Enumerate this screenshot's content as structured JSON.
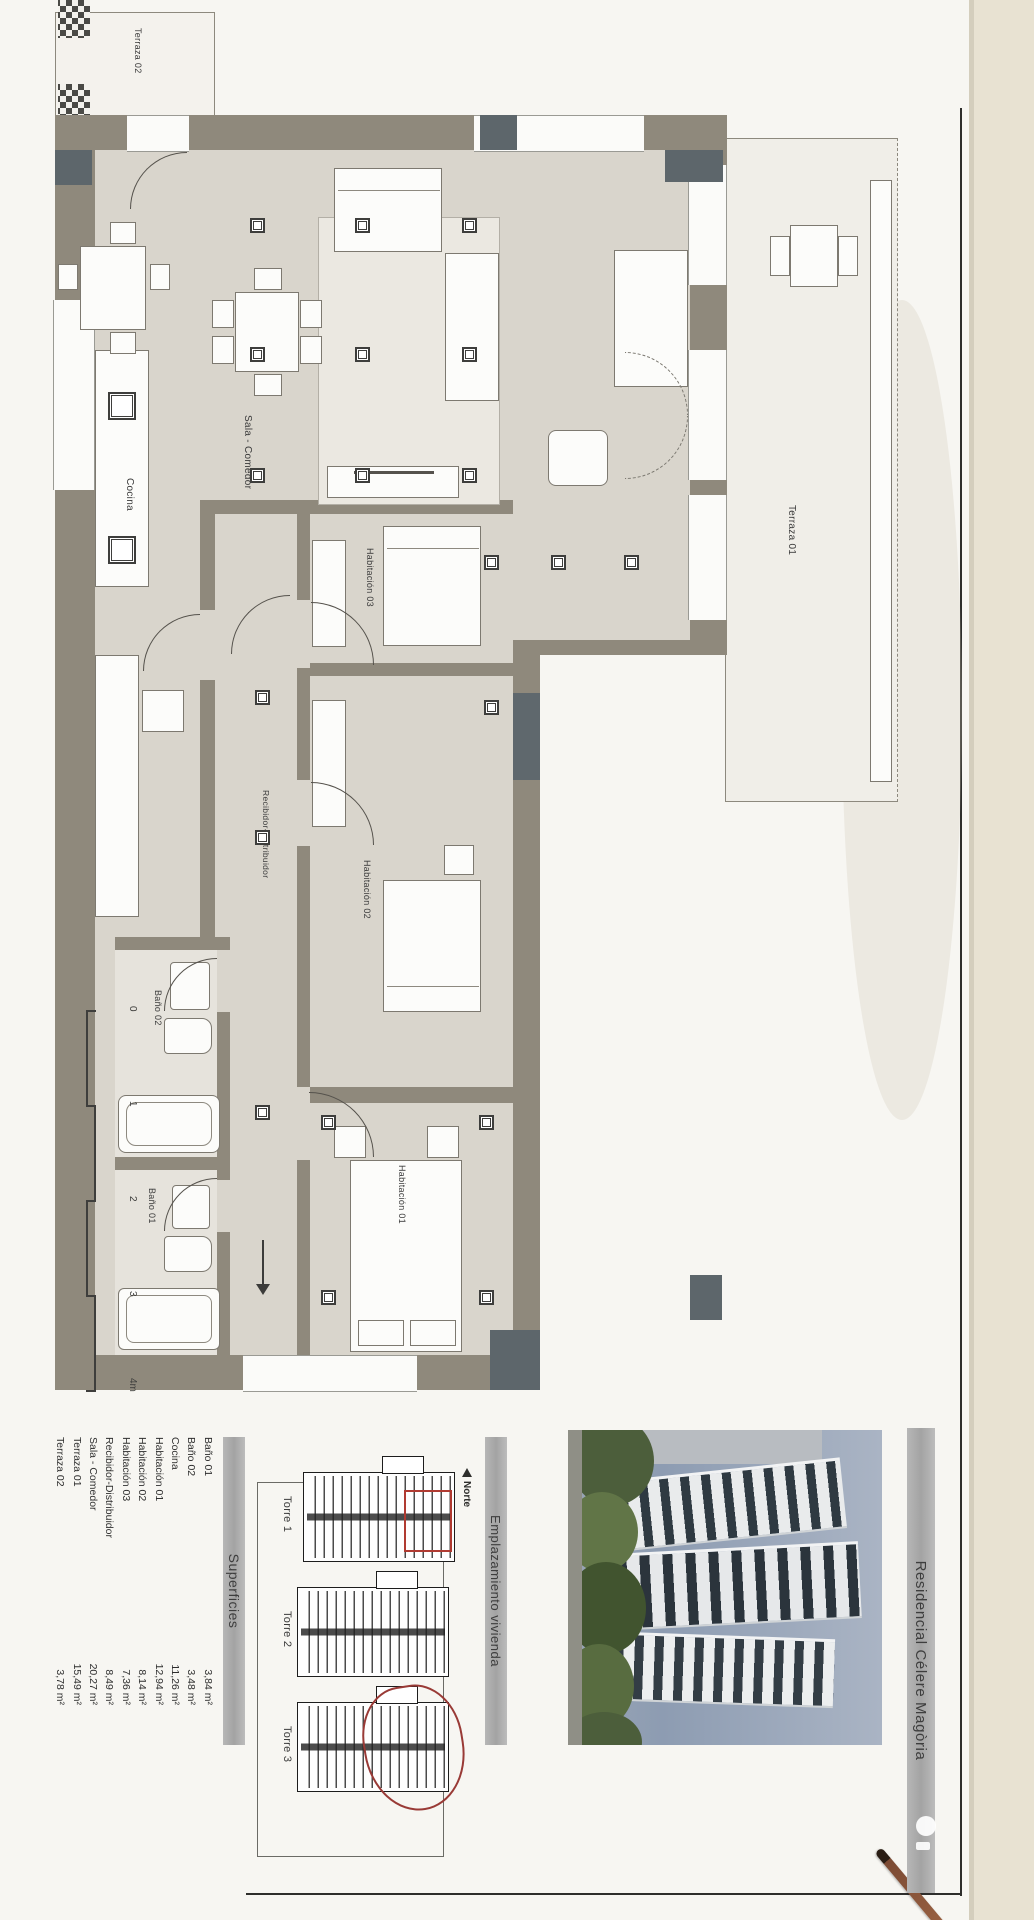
{
  "header": {
    "title": "Residencial Célere Magòria"
  },
  "superficies": {
    "title": "Superficies",
    "rows": [
      {
        "name": "Baño 01",
        "value": "3,84 m²"
      },
      {
        "name": "Baño 02",
        "value": "3,48 m²"
      },
      {
        "name": "Cocina",
        "value": "11,26 m²"
      },
      {
        "name": "Habitación 01",
        "value": "12,94 m²"
      },
      {
        "name": "Habitación 02",
        "value": "8,14 m²"
      },
      {
        "name": "Habitación 03",
        "value": "7,36 m²"
      },
      {
        "name": "Recibidor-Distribuidor",
        "value": "8,49 m²"
      },
      {
        "name": "Sala - Comedor",
        "value": "20,27 m²"
      },
      {
        "name": "Terraza 01",
        "value": "15,49 m²"
      },
      {
        "name": "Terraza 02",
        "value": "3,78 m²"
      }
    ]
  },
  "emplazamiento": {
    "title": "Emplazamiento vivienda",
    "north_label": "Norte",
    "towers": [
      "Torre 1",
      "Torre 2",
      "Torre 3"
    ]
  },
  "plan": {
    "rooms": {
      "terraza01": "Terraza 01",
      "terraza02": "Terraza 02",
      "cocina": "Cocina",
      "sala": "Sala - Comedor",
      "hab01": "Habitación 01",
      "hab02": "Habitación 02",
      "hab03": "Habitación 03",
      "recibidor": "Recibidor-Distribuidor",
      "bano01": "Baño 01",
      "bano02": "Baño 02"
    },
    "scale_labels": [
      "0",
      "1",
      "2",
      "3",
      "4m"
    ]
  },
  "colors": {
    "wall": "#8f897c",
    "pillar": "#5d666b",
    "annotation_red": "#b03a31",
    "paper": "#f7f6f2",
    "photo_sky": "#96a3b7"
  }
}
